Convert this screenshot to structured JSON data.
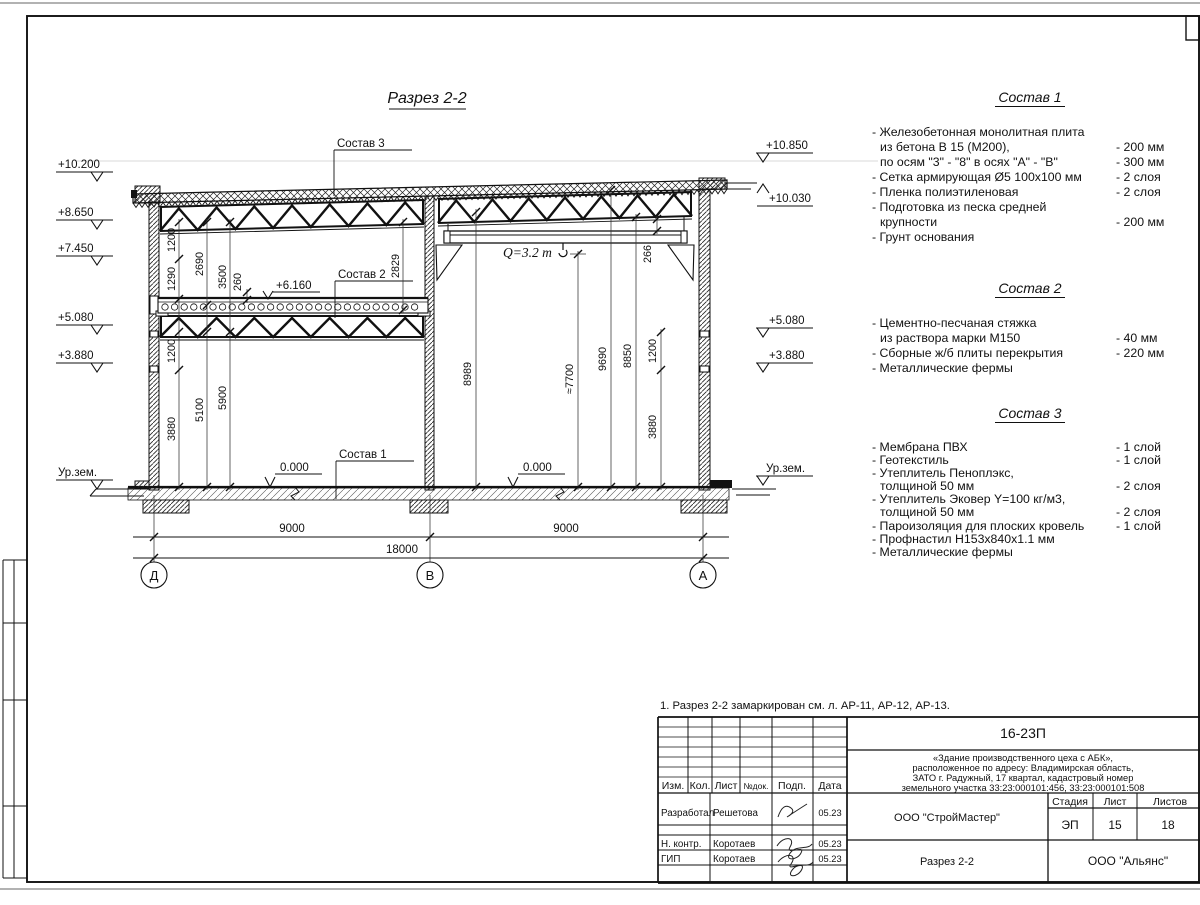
{
  "sheet": {
    "note": "1. Разрез 2-2 замаркирован см. л. АР-11, АР-12, АР-13."
  },
  "section": {
    "title": "Разрез 2-2",
    "callout_sostav3": "Состав 3",
    "callout_sostav2": "Состав 2",
    "callout_sostav1": "Состав 1",
    "elev_6160": "+6.160",
    "zero_left": "0.000",
    "zero_right": "0.000",
    "crane_capacity": "Q=3.2 т",
    "elev_left": [
      "+10.200",
      "+8.650",
      "+7.450",
      "+5.080",
      "+3.880",
      "Ур.зем."
    ],
    "elev_right": [
      "+10.850",
      "+10.030",
      "+5.080",
      "+3.880",
      "Ур.зем."
    ],
    "vdims": [
      "1200",
      "1290",
      "2690",
      "3500",
      "260",
      "2829",
      "1200",
      "3880",
      "5100",
      "5900",
      "8989",
      "≈7700",
      "9690",
      "8850",
      "1200",
      "3880",
      "266"
    ],
    "hdims": [
      "9000",
      "9000",
      "18000"
    ],
    "axes": [
      "Д",
      "В",
      "А"
    ]
  },
  "compositions": [
    {
      "title": "Состав 1",
      "rows": [
        {
          "text": "- Железобетонная  монолитная плита",
          "value": ""
        },
        {
          "text": "из бетона В 15 (М200),",
          "value": "- 200 мм"
        },
        {
          "text": "по осям \"3\" - \"8\" в осях \"А\" - \"В\"",
          "value": "- 300 мм"
        },
        {
          "text": "- Сетка армирующая Ø5 100х100 мм",
          "value": "- 2 слоя"
        },
        {
          "text": "- Пленка полиэтиленовая",
          "value": "-  2 слоя"
        },
        {
          "text": "- Подготовка из песка средней",
          "value": ""
        },
        {
          "text": "крупности",
          "value": "- 200 мм"
        },
        {
          "text": "- Грунт основания",
          "value": ""
        }
      ]
    },
    {
      "title": "Состав 2",
      "rows": [
        {
          "text": "- Цементно-песчаная стяжка",
          "value": ""
        },
        {
          "text": "из раствора марки М150",
          "value": "- 40 мм"
        },
        {
          "text": "- Сборные ж/б плиты перекрытия",
          "value": "- 220 мм"
        },
        {
          "text": "- Металлические фермы",
          "value": ""
        }
      ]
    },
    {
      "title": "Состав 3",
      "rows": [
        {
          "text": "- Мембрана ПВХ",
          "value": "- 1 слой"
        },
        {
          "text": "- Геотекстиль",
          "value": "- 1 слой"
        },
        {
          "text": "- Утеплитель Пеноплэкс,",
          "value": ""
        },
        {
          "text": "толщиной 50 мм",
          "value": "- 2 слоя"
        },
        {
          "text": "- Утеплитель Эковер Y=100 кг/м3,",
          "value": ""
        },
        {
          "text": "толщиной 50 мм",
          "value": "- 2 слоя"
        },
        {
          "text": "- Пароизоляция для плоских кровель",
          "value": "- 1 слой"
        },
        {
          "text": "- Профнастил Н153х840х1.1 мм",
          "value": ""
        },
        {
          "text": "- Металлические фермы",
          "value": ""
        }
      ]
    }
  ],
  "titleblock": {
    "code": "16-23П",
    "object_lines": [
      "«Здание производственного цеха с АБК»,",
      "расположенное по адресу: Владимирская область,",
      "ЗАТО г. Радужный, 17 квартал, кадастровый номер",
      "земельного участка 33:23:000101:456, 33:23:000101:508"
    ],
    "col_headers": [
      "Изм.",
      "Кол.",
      "Лист",
      "№док.",
      "Подп.",
      "Дата"
    ],
    "rows": [
      {
        "role": "Разработал",
        "name": "Решетова",
        "date": "05.23"
      },
      {
        "role": "Н. контр.",
        "name": "Коротаев",
        "date": "05.23"
      },
      {
        "role": "ГИП",
        "name": "Коротаев",
        "date": "05.23"
      }
    ],
    "designer_org": "ООО \"СтройМастер\"",
    "customer_org": "ООО \"Альянс\"",
    "doc_title": "Разрез 2-2",
    "stage_label": "Стадия",
    "sheet_label": "Лист",
    "sheets_label": "Листов",
    "stage": "ЭП",
    "sheet_num": "15",
    "sheets_total": "18"
  }
}
